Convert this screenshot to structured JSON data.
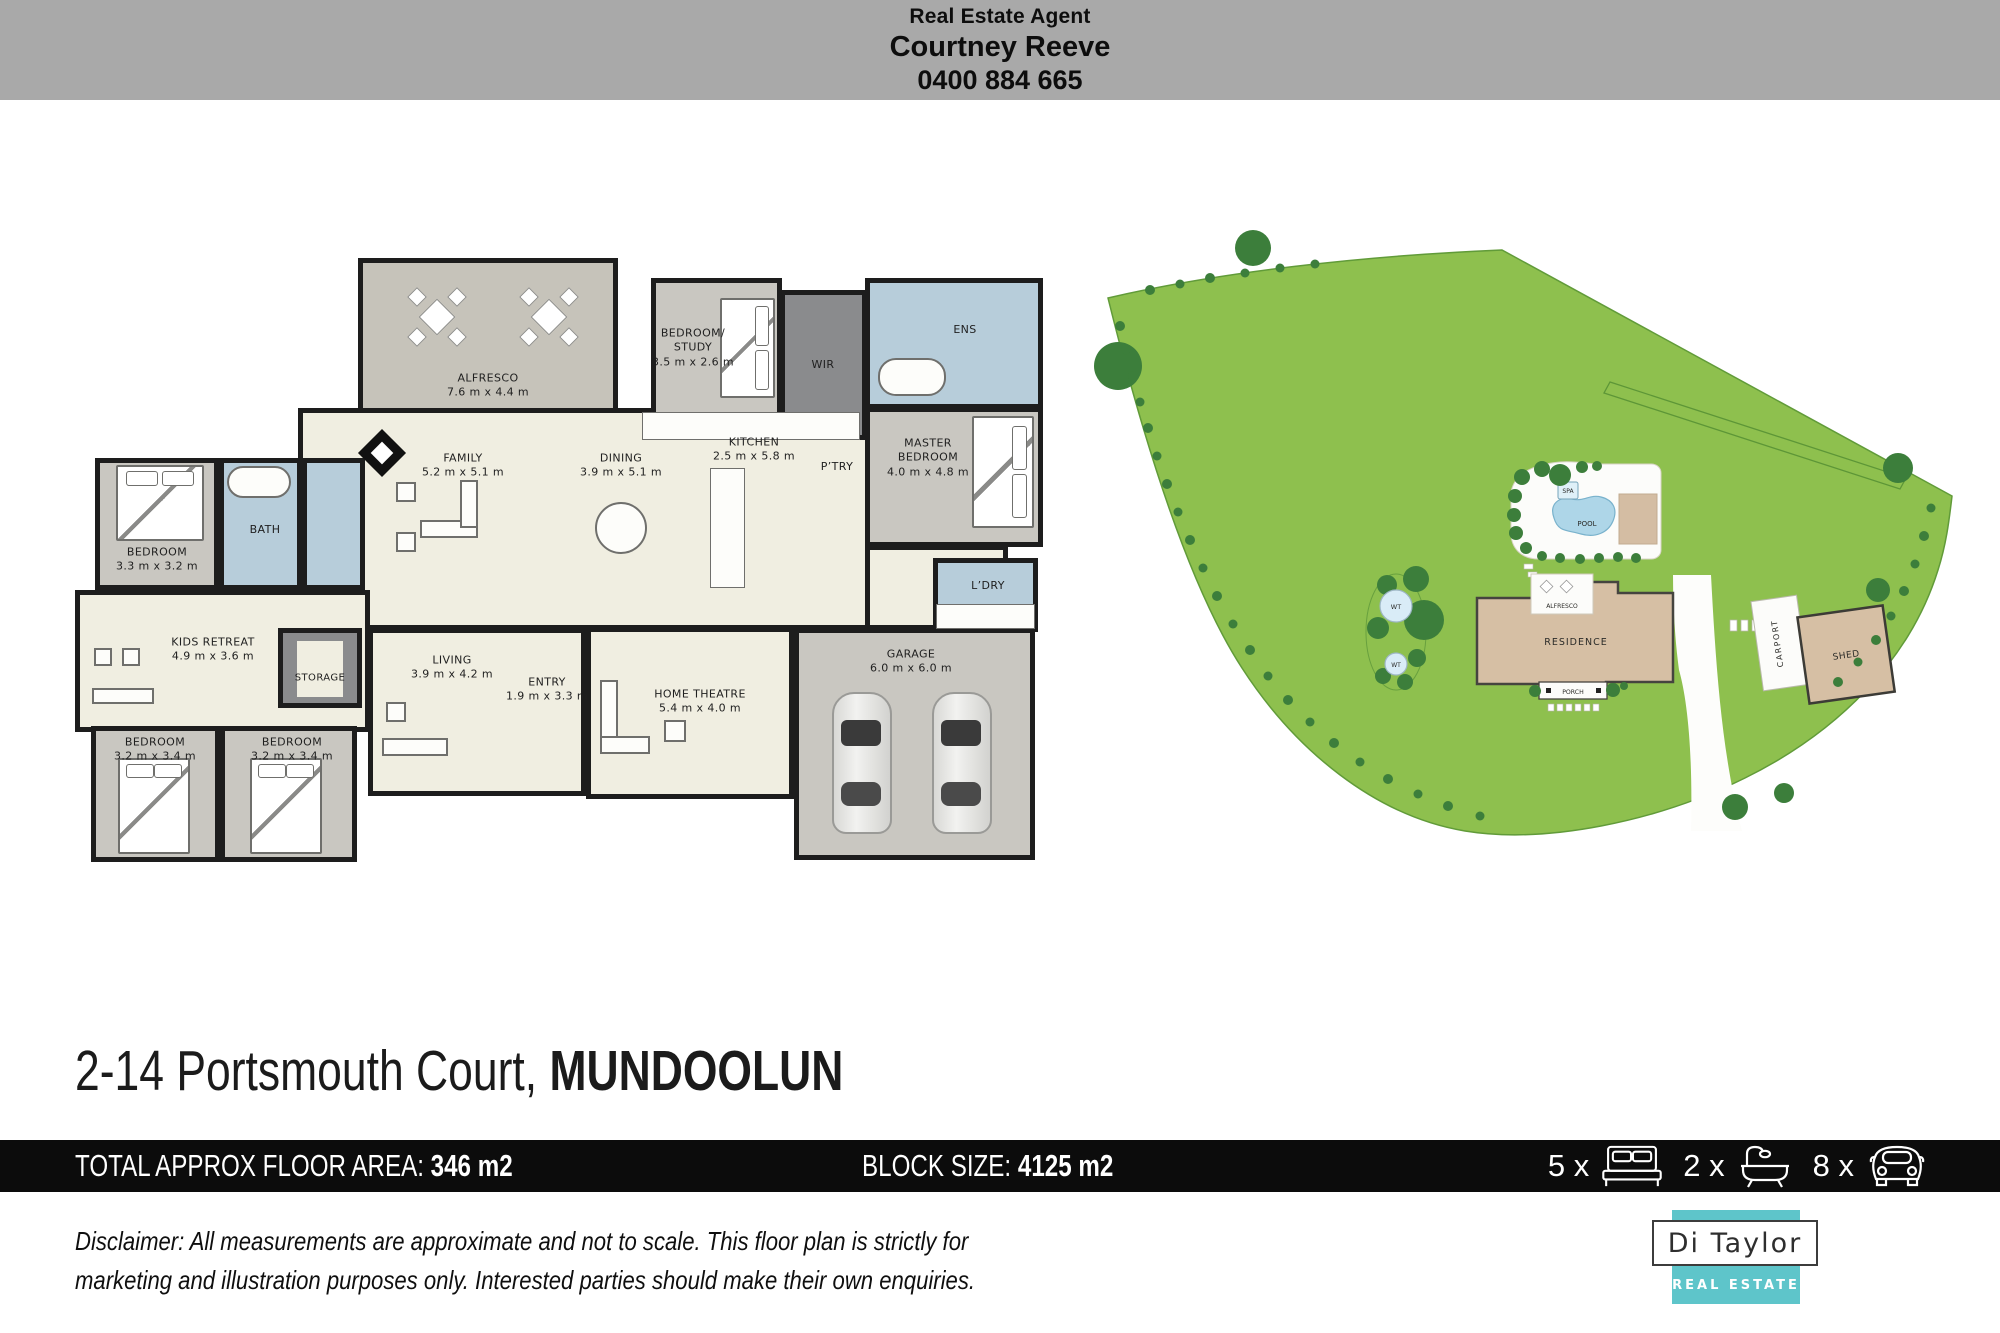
{
  "header": {
    "role": "Real Estate Agent",
    "name": "Courtney Reeve",
    "phone": "0400 884 665"
  },
  "floorplan": {
    "rooms": {
      "alfresco": {
        "label": "ALFRESCO",
        "dims": "7.6 m x 4.4 m"
      },
      "bedroom_study": {
        "label": "BEDROOM/ STUDY",
        "dims": "3.5 m x 2.6 m"
      },
      "wir": {
        "label": "WIR"
      },
      "ens": {
        "label": "ENS"
      },
      "master": {
        "label": "MASTER BEDROOM",
        "dims": "4.0 m x 4.8 m"
      },
      "family": {
        "label": "FAMILY",
        "dims": "5.2 m x 5.1 m"
      },
      "dining": {
        "label": "DINING",
        "dims": "3.9 m x 5.1 m"
      },
      "kitchen": {
        "label": "KITCHEN",
        "dims": "2.5 m x 5.8 m"
      },
      "pantry": {
        "label": "P’TRY"
      },
      "bedroom2": {
        "label": "BEDROOM",
        "dims": "3.3 m x 3.2 m"
      },
      "bath": {
        "label": "BATH"
      },
      "kids_retreat": {
        "label": "KIDS RETREAT",
        "dims": "4.9 m x 3.6 m"
      },
      "storage": {
        "label": "STORAGE"
      },
      "bedroom3": {
        "label": "BEDROOM",
        "dims": "3.2 m x 3.4 m"
      },
      "bedroom4": {
        "label": "BEDROOM",
        "dims": "3.2 m x 3.4 m"
      },
      "living": {
        "label": "LIVING",
        "dims": "3.9 m x 4.2 m"
      },
      "entry": {
        "label": "ENTRY",
        "dims": "1.9 m x 3.3 m"
      },
      "home_theatre": {
        "label": "HOME THEATRE",
        "dims": "5.4 m x 4.0 m"
      },
      "laundry": {
        "label": "L’DRY"
      },
      "garage": {
        "label": "GARAGE",
        "dims": "6.0 m x 6.0 m"
      }
    }
  },
  "siteplan": {
    "labels": {
      "spa": "SPA",
      "pool": "POOL",
      "alfresco": "ALFRESCO",
      "residence": "RESIDENCE",
      "porch": "PORCH",
      "carport": "CARPORT",
      "shed": "SHED",
      "wt": "WT"
    }
  },
  "address": {
    "street": "2-14 Portsmouth Court, ",
    "suburb": "MUNDOOLUN"
  },
  "infobar": {
    "floor_area_label": "TOTAL APPROX FLOOR AREA: ",
    "floor_area_value": "346 m2",
    "block_label": "BLOCK SIZE: ",
    "block_value": "4125 m2",
    "beds_count": "5 x",
    "baths_count": "2 x",
    "cars_count": "8 x"
  },
  "disclaimer": {
    "line1": "Disclaimer: All measurements are approximate and not to scale. This floor plan is strictly for",
    "line2": "marketing and illustration purposes only. Interested parties should make their own enquiries."
  },
  "logo": {
    "name": "Di Taylor",
    "tag": "REAL ESTATE"
  },
  "colors": {
    "header_gray": "#a9a9a9",
    "bar_black": "#0c0c0c",
    "logo_teal": "#5ec5ca",
    "site_green": "#8ec04e",
    "residence_tan": "#d6bfa4",
    "wet_area_blue": "#b7cdda",
    "floor_cream": "#f0eee1"
  }
}
